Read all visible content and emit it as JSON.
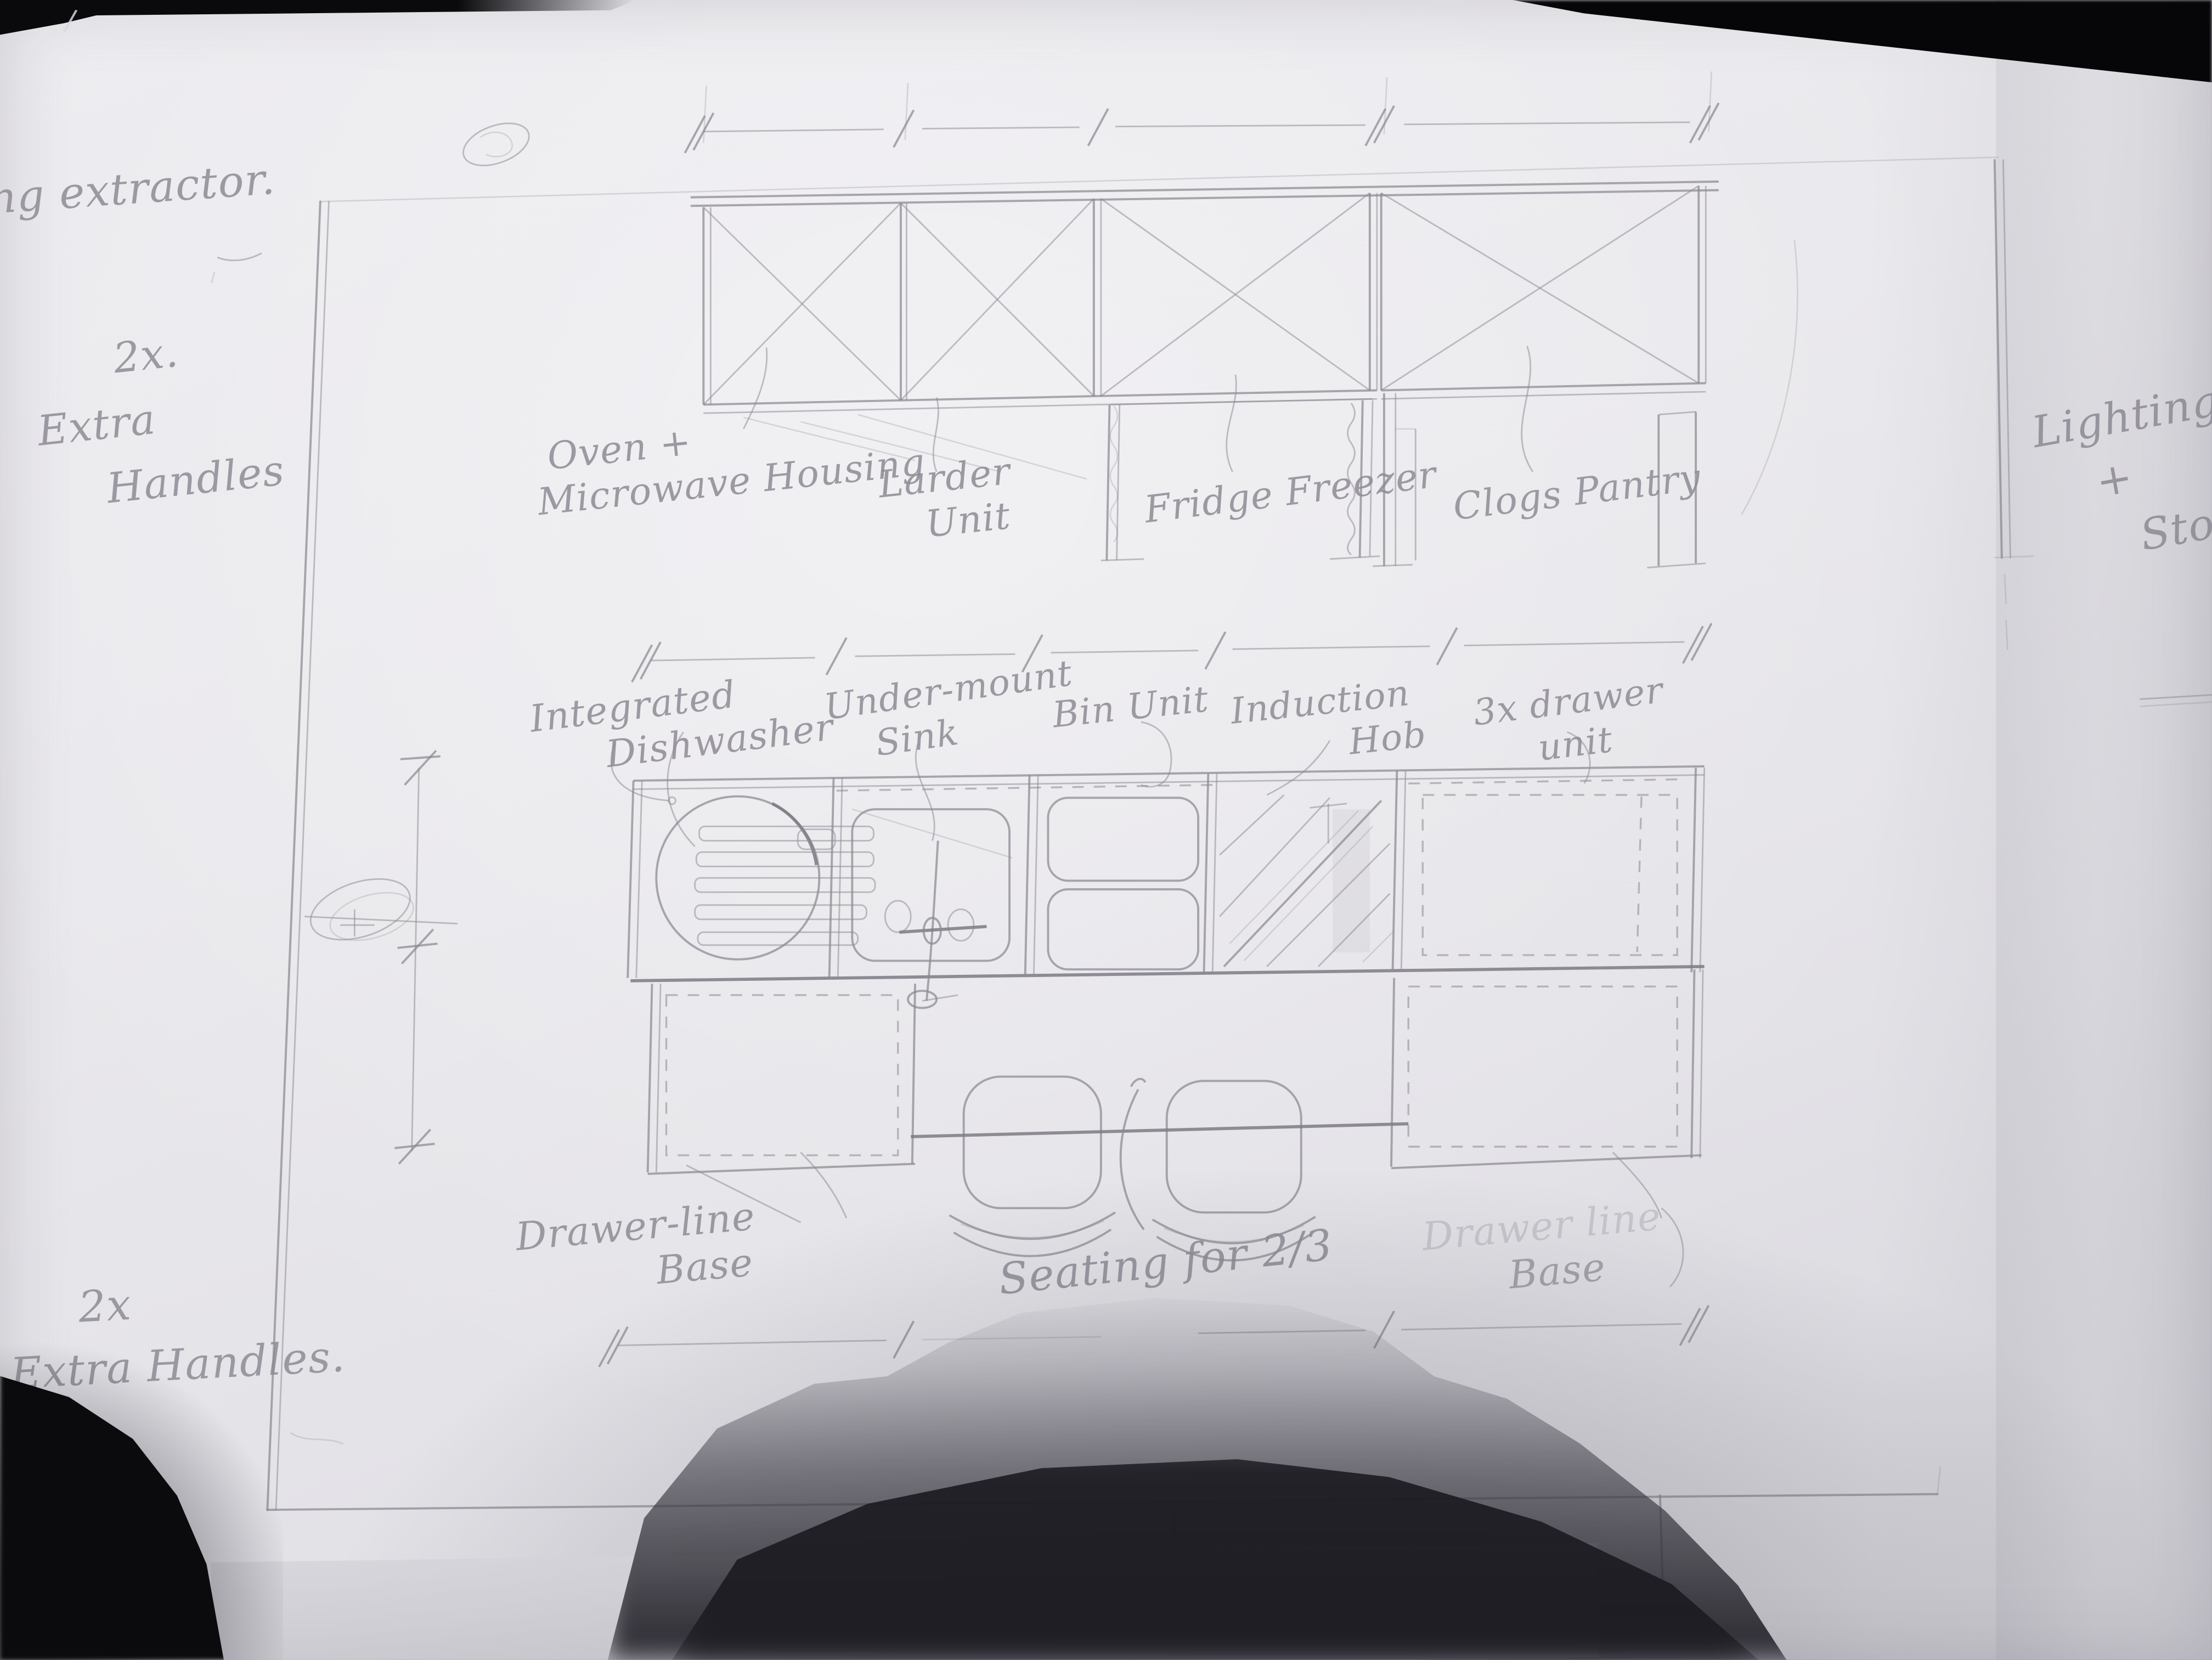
{
  "photo": {
    "paper_color": "#e9e8ec",
    "pencil_color": "#8d8b94",
    "shadow_color": "#26252c"
  },
  "corner_mark": "/",
  "notes": {
    "extractor": [
      "ung extractor."
    ],
    "handles_top": [
      "2x.",
      "Extra",
      "Handles"
    ],
    "lighting": [
      "Lighting",
      "+",
      "Stool"
    ],
    "handles_bottom": [
      "2x",
      "Extra Handles."
    ]
  },
  "wall_units": {
    "oven": [
      "Oven +",
      "Microwave Housing"
    ],
    "larder": [
      "Larder",
      "Unit"
    ],
    "fridge": [
      "Fridge Freezer"
    ],
    "pantry": [
      "Clogs Pantry"
    ]
  },
  "base_units": {
    "dishwasher": [
      "Integrated",
      "Dishwasher"
    ],
    "sink": [
      "Under-mount",
      "Sink"
    ],
    "bin": [
      "Bin Unit"
    ],
    "hob": [
      "Induction",
      "Hob"
    ],
    "drawers": [
      "3x drawer",
      "unit"
    ]
  },
  "island": {
    "base_left": [
      "Drawer-line",
      "Base"
    ],
    "seating": [
      "Seating for 2/3"
    ],
    "base_right": [
      "Drawer line",
      "Base"
    ]
  }
}
